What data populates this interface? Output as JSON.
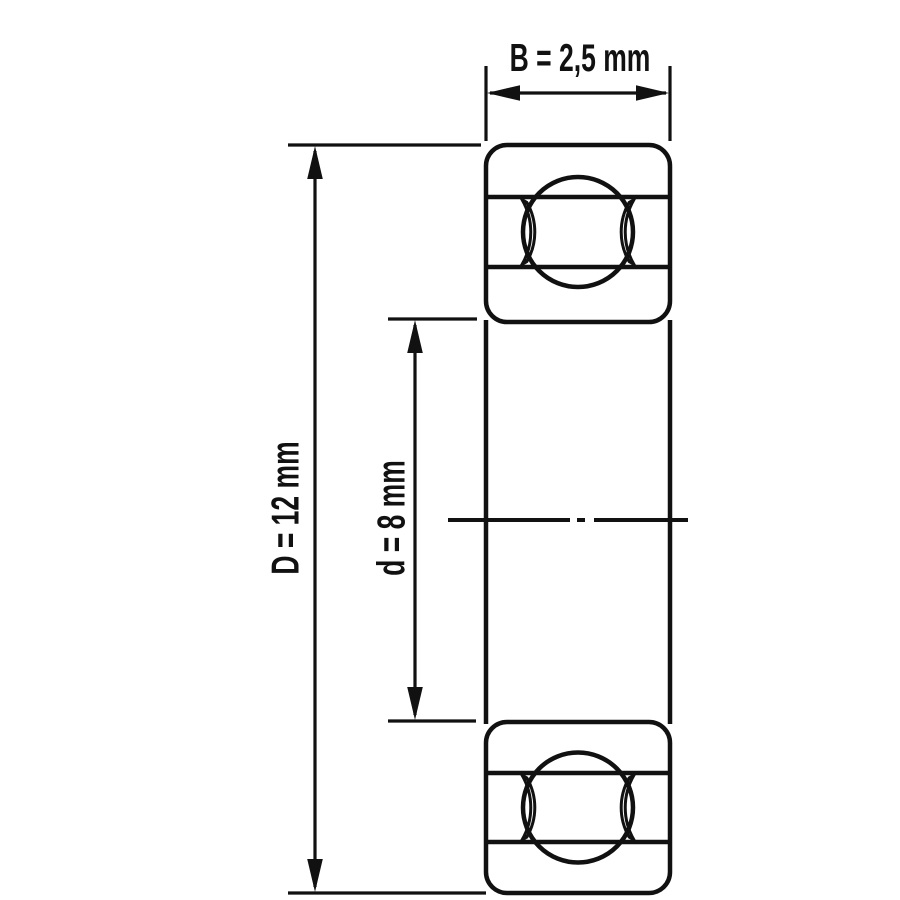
{
  "diagram": {
    "type": "technical-drawing",
    "subject": "ball-bearing-cross-section",
    "dimensions": [
      {
        "name": "B",
        "value": "2,5 mm",
        "label": "B = 2,5 mm",
        "measures": "width"
      },
      {
        "name": "D",
        "value": "12 mm",
        "label": "D = 12 mm",
        "measures": "outer-diameter"
      },
      {
        "name": "d",
        "value": "8 mm",
        "label": "d = 8 mm",
        "measures": "bore-diameter"
      }
    ],
    "colors": {
      "background": "#ffffff",
      "line": "#111111",
      "ring_fill": "#d5d5d5",
      "ball_fill": "#ffffff"
    }
  }
}
